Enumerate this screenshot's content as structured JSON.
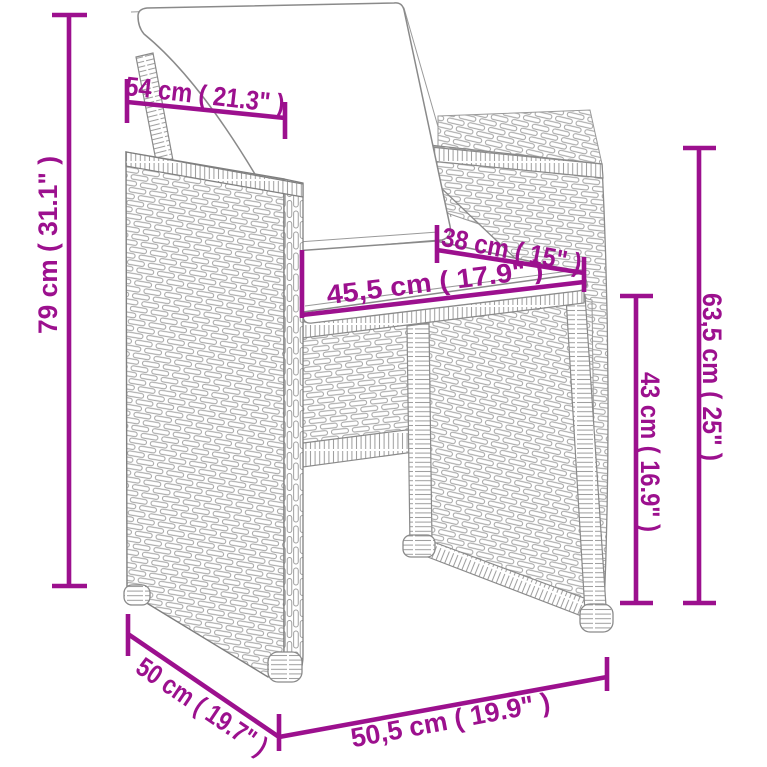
{
  "figure": {
    "subject": "rattan armchair with seat and back cushions, dimension diagram"
  },
  "colors": {
    "dimension_accent": "#9C108E",
    "drawing_outline": "#868686",
    "background": "#FFFFFF"
  },
  "dimensions": [
    {
      "id": "backrest-top-width",
      "label": "54 cm ( 21.3\" )"
    },
    {
      "id": "overall-height",
      "label": "79 cm ( 31.1\" )"
    },
    {
      "id": "seat-depth",
      "label": "38 cm ( 15\" )"
    },
    {
      "id": "seat-width",
      "label": "45,5 cm ( 17.9\" )"
    },
    {
      "id": "side-height",
      "label": "63,5 cm ( 25\" )"
    },
    {
      "id": "seat-height",
      "label": "43 cm ( 16.9\" )"
    },
    {
      "id": "base-depth",
      "label": "50 cm ( 19.7\" )"
    },
    {
      "id": "base-width",
      "label": "50,5 cm ( 19.9\" )"
    }
  ]
}
